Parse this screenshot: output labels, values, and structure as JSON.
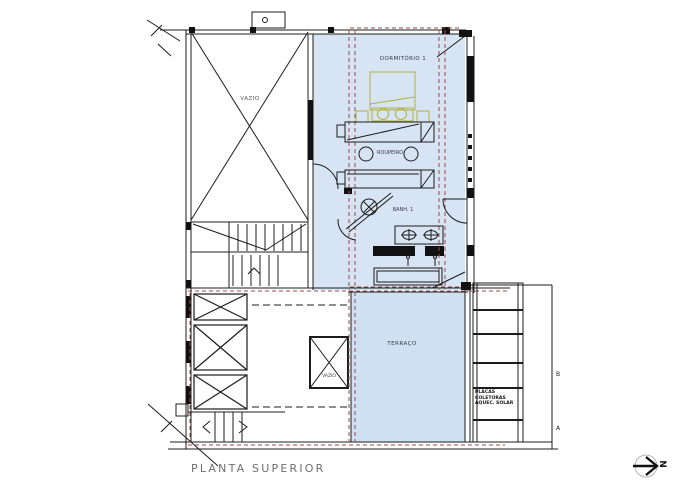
{
  "drawing": {
    "title": "PLANTA SUPERIOR",
    "north_label": "N",
    "rooms": {
      "void_upper": "VAZIO",
      "dormitorio": "DORMITÓRIO 1",
      "roupeiro": "ROUPEIRO",
      "banheiro": "BANH. 1",
      "terraco": "TERRAÇO",
      "void_lower": "VAZIO"
    },
    "annotations": {
      "solar_line1": "PLACAS",
      "solar_line2": "COLETORAS",
      "solar_line3": "AQUEC. SOLAR",
      "section_b": "B",
      "section_a": "A"
    },
    "colors": {
      "room_fill_upper": "#d7e4f4",
      "room_fill_terrace": "#cfe0f2",
      "projection_line": "#9a4a4a",
      "furniture_accent": "#b1b13e",
      "linework": "#1c1c1c",
      "title_text": "#6e6e6e"
    }
  }
}
